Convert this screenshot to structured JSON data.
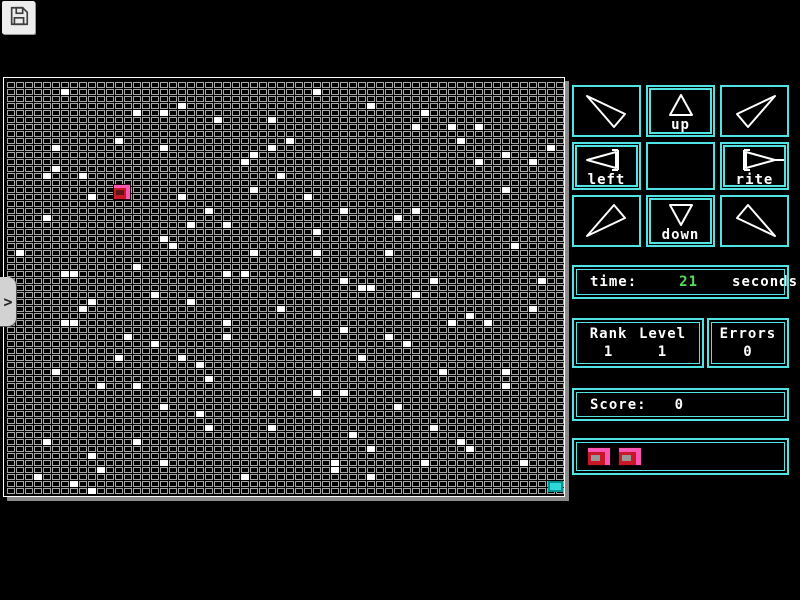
{
  "toolbar": {
    "save_icon": "floppy-disk"
  },
  "board": {
    "cols": 62,
    "rows": 59,
    "handle_glyph": ">",
    "player": {
      "col": 12,
      "row": 15
    },
    "goal": {
      "col": 60,
      "row": 57
    },
    "white_cells": [
      [
        6,
        1
      ],
      [
        14,
        4
      ],
      [
        17,
        4
      ],
      [
        19,
        3
      ],
      [
        23,
        5
      ],
      [
        29,
        5
      ],
      [
        12,
        8
      ],
      [
        5,
        9
      ],
      [
        17,
        9
      ],
      [
        29,
        9
      ],
      [
        27,
        10
      ],
      [
        26,
        11
      ],
      [
        4,
        13
      ],
      [
        8,
        13
      ],
      [
        30,
        13
      ],
      [
        5,
        12
      ],
      [
        19,
        16
      ],
      [
        27,
        15
      ],
      [
        9,
        16
      ],
      [
        22,
        18
      ],
      [
        4,
        19
      ],
      [
        20,
        20
      ],
      [
        24,
        20
      ],
      [
        17,
        22
      ],
      [
        18,
        23
      ],
      [
        1,
        24
      ],
      [
        27,
        24
      ],
      [
        14,
        26
      ],
      [
        6,
        27
      ],
      [
        7,
        27
      ],
      [
        24,
        27
      ],
      [
        26,
        27
      ],
      [
        34,
        1
      ],
      [
        40,
        3
      ],
      [
        46,
        4
      ],
      [
        45,
        6
      ],
      [
        49,
        6
      ],
      [
        52,
        6
      ],
      [
        31,
        8
      ],
      [
        50,
        8
      ],
      [
        60,
        9
      ],
      [
        55,
        10
      ],
      [
        52,
        11
      ],
      [
        58,
        11
      ],
      [
        55,
        15
      ],
      [
        33,
        16
      ],
      [
        37,
        18
      ],
      [
        45,
        18
      ],
      [
        43,
        19
      ],
      [
        34,
        21
      ],
      [
        56,
        23
      ],
      [
        34,
        24
      ],
      [
        42,
        24
      ],
      [
        37,
        28
      ],
      [
        47,
        28
      ],
      [
        59,
        28
      ],
      [
        16,
        30
      ],
      [
        9,
        31
      ],
      [
        20,
        31
      ],
      [
        8,
        32
      ],
      [
        30,
        32
      ],
      [
        6,
        34
      ],
      [
        7,
        34
      ],
      [
        24,
        34
      ],
      [
        13,
        36
      ],
      [
        24,
        36
      ],
      [
        16,
        37
      ],
      [
        12,
        39
      ],
      [
        19,
        39
      ],
      [
        21,
        40
      ],
      [
        5,
        41
      ],
      [
        22,
        42
      ],
      [
        10,
        43
      ],
      [
        14,
        43
      ],
      [
        17,
        46
      ],
      [
        21,
        47
      ],
      [
        22,
        49
      ],
      [
        29,
        49
      ],
      [
        4,
        51
      ],
      [
        14,
        51
      ],
      [
        9,
        53
      ],
      [
        17,
        54
      ],
      [
        10,
        55
      ],
      [
        3,
        56
      ],
      [
        26,
        56
      ],
      [
        7,
        57
      ],
      [
        9,
        58
      ],
      [
        39,
        29
      ],
      [
        40,
        29
      ],
      [
        45,
        30
      ],
      [
        51,
        33
      ],
      [
        58,
        32
      ],
      [
        49,
        34
      ],
      [
        53,
        34
      ],
      [
        37,
        35
      ],
      [
        42,
        36
      ],
      [
        44,
        37
      ],
      [
        39,
        39
      ],
      [
        48,
        41
      ],
      [
        55,
        41
      ],
      [
        55,
        43
      ],
      [
        34,
        44
      ],
      [
        37,
        44
      ],
      [
        43,
        46
      ],
      [
        47,
        49
      ],
      [
        38,
        50
      ],
      [
        50,
        51
      ],
      [
        51,
        52
      ],
      [
        40,
        52
      ],
      [
        36,
        54
      ],
      [
        46,
        54
      ],
      [
        57,
        54
      ],
      [
        36,
        55
      ],
      [
        40,
        56
      ]
    ]
  },
  "controls": {
    "cells": [
      {
        "dir": "nw",
        "label": ""
      },
      {
        "dir": "n",
        "label": "up"
      },
      {
        "dir": "ne",
        "label": ""
      },
      {
        "dir": "w",
        "label": "left"
      },
      {
        "dir": "none",
        "label": ""
      },
      {
        "dir": "e",
        "label": "rite"
      },
      {
        "dir": "sw",
        "label": ""
      },
      {
        "dir": "s",
        "label": "down"
      },
      {
        "dir": "se",
        "label": ""
      }
    ]
  },
  "status": {
    "time_label": "time:",
    "time_value": "21",
    "time_unit": "seconds",
    "rank_label": "Rank",
    "rank_value": "1",
    "level_label": "Level",
    "level_value": "1",
    "errors_label": "Errors",
    "errors_value": "0",
    "score_label": "Score:",
    "score_value": "0",
    "lives_count": 2
  },
  "colors": {
    "cyan": "#4fe3e3",
    "green": "#54df54",
    "white": "#ffffff",
    "brick": "#a6a6a6",
    "red": "#c81828",
    "pink": "#ff55b5",
    "inner-gray": "#989898",
    "goal": "#2fd8d8",
    "handle": "#d2d2d2",
    "btn": "#ededed"
  }
}
